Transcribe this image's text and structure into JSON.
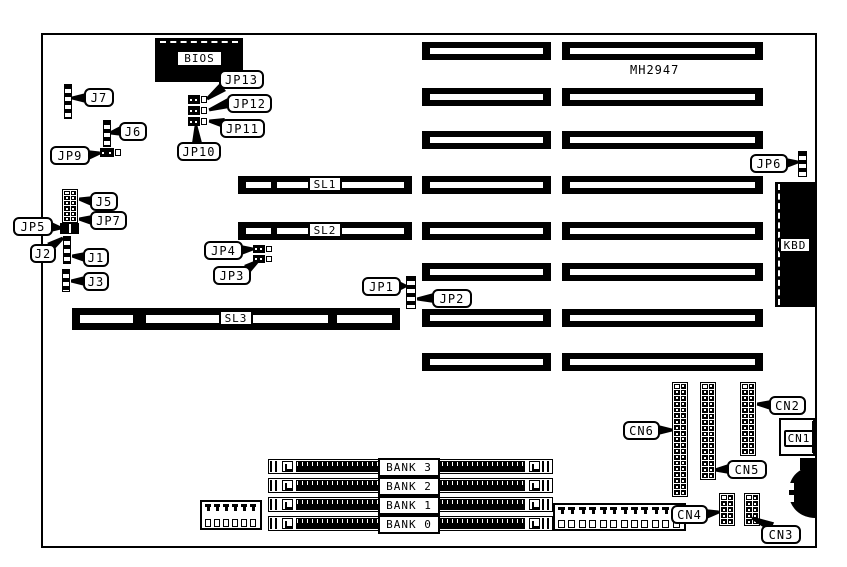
{
  "colors": {
    "ink": "#000000",
    "paper": "#ffffff"
  },
  "diagram": {
    "board": {
      "x": 41,
      "y": 33,
      "w": 776,
      "h": 515
    },
    "free_text": [
      {
        "id": "chipset-part-number",
        "text": "MH2947",
        "x": 630,
        "y": 63
      }
    ],
    "slots": [
      {
        "id": "isa-slot-a1",
        "x": 422,
        "y": 42,
        "w": 129,
        "h": 18
      },
      {
        "id": "isa-slot-b1",
        "x": 562,
        "y": 42,
        "w": 201,
        "h": 18
      },
      {
        "id": "isa-slot-a2",
        "x": 422,
        "y": 88,
        "w": 129,
        "h": 18
      },
      {
        "id": "isa-slot-b2",
        "x": 562,
        "y": 88,
        "w": 201,
        "h": 18
      },
      {
        "id": "isa-slot-a3",
        "x": 422,
        "y": 131,
        "w": 129,
        "h": 18
      },
      {
        "id": "isa-slot-b3",
        "x": 562,
        "y": 131,
        "w": 201,
        "h": 18
      },
      {
        "id": "slot-sl1",
        "label": "SL1",
        "x": 238,
        "y": 176,
        "w": 174,
        "h": 18,
        "gaps": [
          [
            33,
            6
          ]
        ]
      },
      {
        "id": "isa-slot-a4",
        "x": 422,
        "y": 176,
        "w": 129,
        "h": 18
      },
      {
        "id": "isa-slot-b4",
        "x": 562,
        "y": 176,
        "w": 201,
        "h": 18
      },
      {
        "id": "slot-sl2",
        "label": "SL2",
        "x": 238,
        "y": 222,
        "w": 174,
        "h": 18,
        "gaps": [
          [
            33,
            6
          ]
        ]
      },
      {
        "id": "isa-slot-a5",
        "x": 422,
        "y": 222,
        "w": 129,
        "h": 18
      },
      {
        "id": "isa-slot-b5",
        "x": 562,
        "y": 222,
        "w": 201,
        "h": 18
      },
      {
        "id": "isa-slot-a6",
        "x": 422,
        "y": 263,
        "w": 129,
        "h": 18
      },
      {
        "id": "isa-slot-b6",
        "x": 562,
        "y": 263,
        "w": 201,
        "h": 18
      },
      {
        "id": "slot-sl3",
        "label": "SL3",
        "x": 72,
        "y": 308,
        "w": 328,
        "h": 22,
        "gaps": [
          [
            61,
            13
          ],
          [
            256,
            9
          ]
        ]
      },
      {
        "id": "isa-slot-a7",
        "x": 422,
        "y": 309,
        "w": 129,
        "h": 18
      },
      {
        "id": "isa-slot-b7",
        "x": 562,
        "y": 309,
        "w": 201,
        "h": 18
      },
      {
        "id": "isa-slot-a8",
        "x": 422,
        "y": 353,
        "w": 129,
        "h": 18
      },
      {
        "id": "isa-slot-b8",
        "x": 562,
        "y": 353,
        "w": 201,
        "h": 18
      }
    ],
    "striped_headers": [
      {
        "id": "j7-header",
        "x": 64,
        "y": 84,
        "w": 8,
        "h": 35
      },
      {
        "id": "j6-header",
        "x": 103,
        "y": 120,
        "w": 8,
        "h": 27
      },
      {
        "id": "j2-header",
        "x": 63,
        "y": 236,
        "w": 8,
        "h": 28
      },
      {
        "id": "j3-header",
        "x": 62,
        "y": 269,
        "w": 8,
        "h": 23
      },
      {
        "id": "jp1-header",
        "x": 406,
        "y": 276,
        "w": 10,
        "h": 33
      },
      {
        "id": "jp6-header",
        "x": 798,
        "y": 151,
        "w": 9,
        "h": 26
      }
    ],
    "pin_grids": [
      {
        "id": "j5-jp7-block",
        "x": 62,
        "y": 189,
        "cols": 2,
        "rows": 6,
        "w": 16,
        "h": 34
      },
      {
        "id": "cn6-header",
        "x": 672,
        "y": 382,
        "cols": 2,
        "rows": 19,
        "w": 16,
        "h": 115
      },
      {
        "id": "cn5-header",
        "x": 700,
        "y": 382,
        "cols": 2,
        "rows": 16,
        "w": 16,
        "h": 98
      },
      {
        "id": "cn2-header",
        "x": 740,
        "y": 382,
        "cols": 2,
        "rows": 12,
        "w": 16,
        "h": 74
      },
      {
        "id": "cn4-header",
        "x": 719,
        "y": 493,
        "cols": 2,
        "rows": 5,
        "w": 16,
        "h": 33
      },
      {
        "id": "cn3-header",
        "x": 744,
        "y": 493,
        "cols": 2,
        "rows": 5,
        "w": 16,
        "h": 33
      }
    ],
    "jumpers": [
      {
        "id": "jp13-jumper",
        "x": 188,
        "y": 95,
        "w": 20,
        "h": 9
      },
      {
        "id": "jp12-jumper",
        "x": 188,
        "y": 106,
        "w": 20,
        "h": 9
      },
      {
        "id": "jp11-jumper",
        "x": 188,
        "y": 117,
        "w": 20,
        "h": 9
      },
      {
        "id": "jp9-jumper",
        "x": 100,
        "y": 148,
        "w": 22,
        "h": 9
      },
      {
        "id": "jp4-jumper",
        "x": 253,
        "y": 245,
        "w": 20,
        "h": 8
      },
      {
        "id": "jp3-jumper",
        "x": 253,
        "y": 255,
        "w": 20,
        "h": 8
      }
    ],
    "bars": [
      {
        "id": "jp5-jumper",
        "x": 60,
        "y": 223,
        "w": 19,
        "h": 11,
        "slit": true
      },
      {
        "id": "edge-step",
        "x": 800,
        "y": 458,
        "w": 17,
        "h": 12
      }
    ],
    "chips": {
      "bios": {
        "label": "BIOS",
        "x": 155,
        "y": 38,
        "w": 88,
        "h": 44,
        "label_box": {
          "x": 21,
          "y": 12,
          "w": 47,
          "h": 17
        }
      },
      "kbd": {
        "label": "KBD",
        "x": 775,
        "y": 182,
        "w": 42,
        "h": 125,
        "label_box": {
          "x": 4,
          "y": 55,
          "w": 32,
          "h": 16
        }
      },
      "cn1": {
        "label": "CN1",
        "x": 779,
        "y": 418,
        "w": 36,
        "h": 38,
        "label_box": {
          "x": 3,
          "y": 10,
          "w": 30,
          "h": 17
        }
      },
      "din": {
        "x": 789,
        "y": 466,
        "w": 28,
        "h": 52
      }
    },
    "banks": {
      "x": 268,
      "w": 285,
      "row_h": 15,
      "rows_y": [
        459,
        478,
        497,
        516
      ],
      "labels": [
        "BANK 3",
        "BANK 2",
        "BANK 1",
        "BANK 0"
      ],
      "label_box": {
        "x": 378,
        "w": 62,
        "h": 19,
        "ys": [
          458,
          477,
          496,
          515
        ]
      }
    },
    "power_connectors": [
      {
        "id": "power-connector",
        "x": 200,
        "y": 500,
        "w": 62,
        "h": 30,
        "pins": 6
      },
      {
        "id": "aux-pin-connector",
        "x": 553,
        "y": 503,
        "w": 133,
        "h": 28,
        "pins": 12
      }
    ],
    "callouts": [
      {
        "label": "J7",
        "x": 84,
        "y": 88,
        "w": 30,
        "h": 19,
        "ax": 86,
        "ay": 98,
        "tx": 72,
        "ty": 98
      },
      {
        "label": "J6",
        "x": 119,
        "y": 122,
        "w": 28,
        "h": 19,
        "ax": 121,
        "ay": 131,
        "tx": 110,
        "ty": 133
      },
      {
        "label": "JP9",
        "x": 50,
        "y": 146,
        "w": 40,
        "h": 19,
        "ax": 88,
        "ay": 155,
        "tx": 100,
        "ty": 153
      },
      {
        "label": "JP13",
        "x": 219,
        "y": 70,
        "w": 45,
        "h": 19,
        "ax": 223,
        "ay": 87,
        "tx": 207,
        "ty": 99
      },
      {
        "label": "JP12",
        "x": 227,
        "y": 94,
        "w": 45,
        "h": 19,
        "ax": 229,
        "ay": 103,
        "tx": 209,
        "ty": 110
      },
      {
        "label": "JP11",
        "x": 220,
        "y": 119,
        "w": 45,
        "h": 19,
        "ax": 224,
        "ay": 123,
        "tx": 209,
        "ty": 121
      },
      {
        "label": "JP10",
        "x": 177,
        "y": 142,
        "w": 44,
        "h": 19,
        "ax": 197,
        "ay": 143,
        "tx": 196,
        "ty": 126
      },
      {
        "label": "J5",
        "x": 90,
        "y": 192,
        "w": 28,
        "h": 19,
        "ax": 92,
        "ay": 201,
        "tx": 79,
        "ty": 199
      },
      {
        "label": "JP7",
        "x": 90,
        "y": 211,
        "w": 37,
        "h": 19,
        "ax": 92,
        "ay": 220,
        "tx": 79,
        "ty": 219
      },
      {
        "label": "JP5",
        "x": 13,
        "y": 217,
        "w": 40,
        "h": 19,
        "ax": 51,
        "ay": 227,
        "tx": 61,
        "ty": 228
      },
      {
        "label": "J2",
        "x": 30,
        "y": 244,
        "w": 26,
        "h": 19,
        "ax": 50,
        "ay": 247,
        "tx": 63,
        "ty": 238
      },
      {
        "label": "J1",
        "x": 83,
        "y": 248,
        "w": 26,
        "h": 19,
        "ax": 85,
        "ay": 257,
        "tx": 72,
        "ty": 256
      },
      {
        "label": "J3",
        "x": 83,
        "y": 272,
        "w": 26,
        "h": 19,
        "ax": 85,
        "ay": 281,
        "tx": 71,
        "ty": 281
      },
      {
        "label": "JP4",
        "x": 204,
        "y": 241,
        "w": 39,
        "h": 19,
        "ax": 241,
        "ay": 250,
        "tx": 253,
        "ty": 249
      },
      {
        "label": "JP3",
        "x": 213,
        "y": 266,
        "w": 38,
        "h": 19,
        "ax": 247,
        "ay": 269,
        "tx": 258,
        "ty": 261
      },
      {
        "label": "JP1",
        "x": 362,
        "y": 277,
        "w": 39,
        "h": 19,
        "ax": 399,
        "ay": 286,
        "tx": 406,
        "ty": 286
      },
      {
        "label": "JP2",
        "x": 432,
        "y": 289,
        "w": 40,
        "h": 19,
        "ax": 434,
        "ay": 298,
        "tx": 417,
        "ty": 299
      },
      {
        "label": "JP6",
        "x": 750,
        "y": 154,
        "w": 38,
        "h": 19,
        "ax": 786,
        "ay": 163,
        "tx": 798,
        "ty": 162
      },
      {
        "label": "CN6",
        "x": 623,
        "y": 421,
        "w": 37,
        "h": 19,
        "ax": 658,
        "ay": 430,
        "tx": 672,
        "ty": 430
      },
      {
        "label": "CN5",
        "x": 727,
        "y": 460,
        "w": 40,
        "h": 19,
        "ax": 729,
        "ay": 469,
        "tx": 715,
        "ty": 470
      },
      {
        "label": "CN2",
        "x": 769,
        "y": 396,
        "w": 37,
        "h": 19,
        "ax": 771,
        "ay": 405,
        "tx": 757,
        "ty": 404
      },
      {
        "label": "CN4",
        "x": 671,
        "y": 505,
        "w": 37,
        "h": 19,
        "ax": 706,
        "ay": 514,
        "tx": 719,
        "ty": 512
      },
      {
        "label": "CN3",
        "x": 761,
        "y": 525,
        "w": 40,
        "h": 19,
        "ax": 772,
        "ay": 527,
        "tx": 752,
        "ty": 518
      }
    ]
  }
}
